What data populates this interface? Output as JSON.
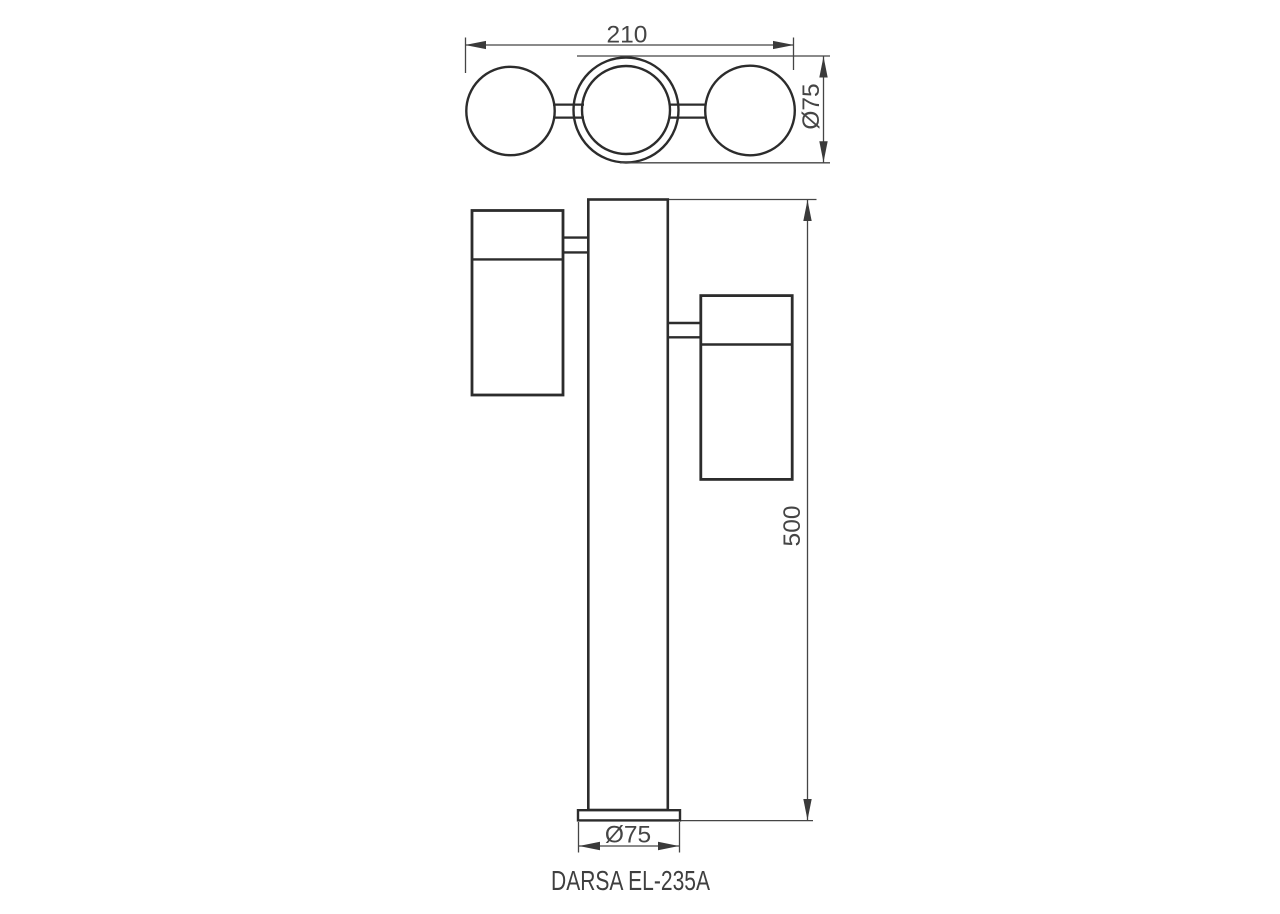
{
  "drawing": {
    "product_name": "DARSA EL-235A",
    "type": "technical-dimension-drawing",
    "views": {
      "top": {
        "name": "top-view",
        "description": "three round lamp heads in a row seen from above, joined by short links",
        "dimensions": {
          "overall_width": {
            "label": "210",
            "value_mm": 210,
            "orientation": "horizontal"
          },
          "head_diameter": {
            "label": "Ø75",
            "value_mm": 75,
            "orientation": "vertical"
          }
        }
      },
      "front": {
        "name": "front-view",
        "description": "vertical post on a base plate with two cylindrical spotlights attached by brackets",
        "dimensions": {
          "overall_height": {
            "label": "500",
            "value_mm": 500,
            "orientation": "vertical"
          },
          "base_diameter": {
            "label": "Ø75",
            "value_mm": 75,
            "orientation": "horizontal"
          }
        }
      }
    }
  },
  "colors": {
    "background": "#ffffff",
    "object_line": "#2c2c2c",
    "dimension_line": "#454545",
    "text": "#454545"
  }
}
